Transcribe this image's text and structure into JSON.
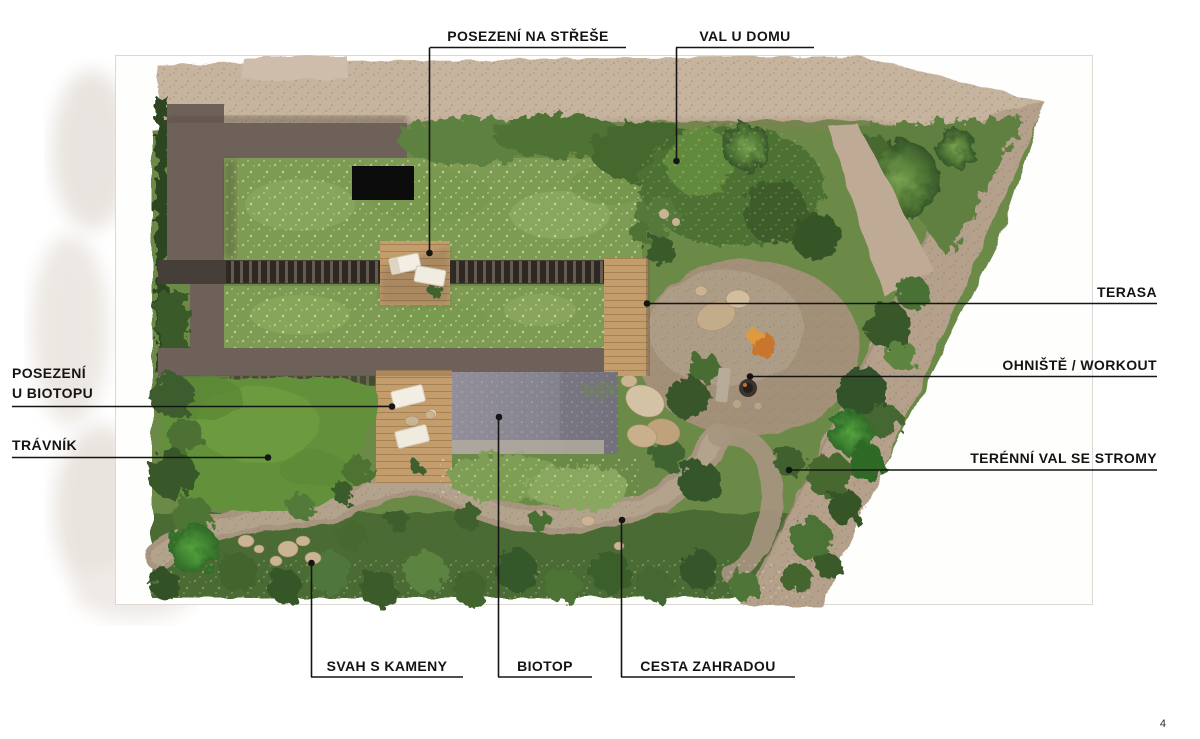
{
  "page": {
    "number": "4"
  },
  "callouts": {
    "roof_seating": "POSEZENÍ NA STŘEŠE",
    "berm_by_house": "VAL U DOMU",
    "terrace": "TERASA",
    "firepit_workout": "OHNIŠTĚ / WORKOUT",
    "terrain_berm_with_trees": "TERÉNNÍ VAL SE STROMY",
    "biotope_seating": {
      "line1": "POSEZENÍ",
      "line2": "U BIOTOPU"
    },
    "lawn": "TRÁVNÍK",
    "slope_with_stones": "SVAH S KAMENY",
    "biotope": "BIOTOP",
    "garden_path": "CESTA ZAHRADOU"
  },
  "plan": {
    "type": "garden landscape design, aerial top-view rendering with callout labels",
    "colors": {
      "label_text": "#141414",
      "leader_line": "#151515",
      "house_roof": "#6e6159",
      "green_roof_meadow": "#7e9b53",
      "lawn_green": "#63913a",
      "pool_water": "#85838f",
      "deck_wood": "#c49d6d",
      "gravel_driveway": "#c7b49f",
      "gravel_road": "#b5a18b",
      "shrub_dark_green": "#37572a",
      "stone_tan": "#cbb493",
      "courtyard_opening": "#0c0c0c"
    }
  }
}
